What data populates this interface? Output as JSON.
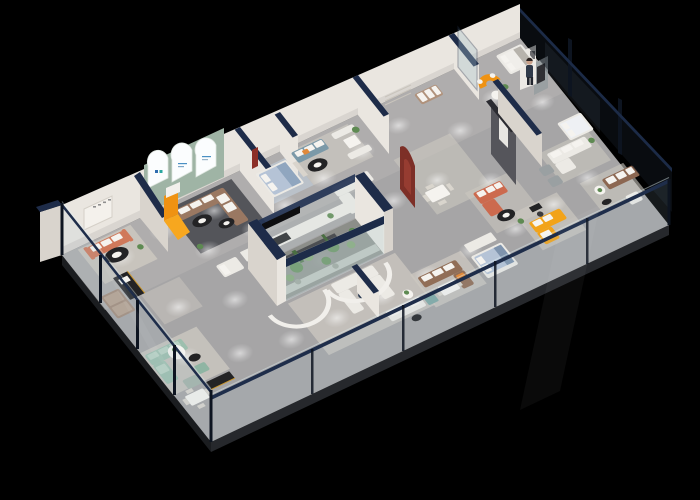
{
  "meta": {
    "type": "3d-isometric-floorplan-render",
    "subject": "Photorealistic isometric cutaway render of a furniture showroom interior on a black background",
    "background": "#000000",
    "width": 700,
    "height": 500
  },
  "palette": {
    "bg": "#000000",
    "floor": "#a6a5a6",
    "floorLight": "#b8b6b4",
    "slab": "#26282c",
    "slabDark": "#1b1d20",
    "wall": "#eae6e0",
    "wallShade": "#d9d4cd",
    "navy": "#1e2c49",
    "sage": "#9fb4a5",
    "glassLight": "#aFc8d2",
    "glassDark": "#141b22",
    "mullion": "#0d1420",
    "white": "#eceae5",
    "cushion": "#f5f3ef",
    "black": "#232325",
    "gray": "#9aa0a2",
    "rugLight": "#ccc8c0",
    "rugDark": "#54555a",
    "coral": "#d0795b",
    "brown": "#9a7862",
    "brown2": "#916e57",
    "taupe": "#a38b7a",
    "tan": "#b0927c",
    "blueGray": "#7b99a8",
    "bedBlue": "#b5c3d6",
    "mint": "#9dbfae",
    "mintDeep": "#8fb5a3",
    "teal": "#7fa8a5",
    "orange": "#ef9212",
    "orangeLight": "#f7a71f",
    "orangeAccent": "#e0893a",
    "yellow": "#f2a319",
    "redOrange": "#cc6a4e",
    "maroon": "#7d2f27",
    "leather": "#8c6751",
    "darkWall": "#55555b",
    "plant": "#5e8a52",
    "plantDark": "#4a6e42",
    "skin": "#caa18a",
    "suit": "#303a49"
  },
  "scene": {
    "view": "high-angle isometric, building runs diagonally from lower-left to upper-right",
    "perimeter": "glass curtain walls with navy top rails on front, left and right sides; solid white wall with room partitions along the back",
    "rooms": [
      {
        "name": "coral-sofa-lounge",
        "furniture": "coral sofa with white cushions, black oval coffee table, wall niche with sign"
      },
      {
        "name": "arched-window-room",
        "furniture": "three glowing arched windows on sage wall, orange kids slide, brown L-sofa on dark rug, two black coffee tables"
      },
      {
        "name": "blue-bedroom",
        "furniture": "light blue bed with white pillows"
      },
      {
        "name": "blue-sofa-room",
        "furniture": "blue-gray sofa with orange pillow, black oval table, white dining booth with plant"
      },
      {
        "name": "mid-lounge",
        "furniture": "white L-sofa, navy table, round dining table with chairs, tan sofa"
      },
      {
        "name": "entrance",
        "furniture": "curved orange sofa, greeter figure, glass door"
      },
      {
        "name": "right-wing",
        "furniture": "white bed, gray headboard wall, white sofa with chaise, gray armchairs, brown leather sofa with white armchair"
      },
      {
        "name": "terrarium",
        "furniture": "glass display box with cacti, plants, pebbles and navy fascia band, white end columns"
      },
      {
        "name": "mint-corner",
        "furniture": "mint green sectional, ottoman, round table, white dining set, black media consoles with brass trim"
      },
      {
        "name": "center-lounge",
        "furniture": "white booth sofas, white sofa with teal ottoman, curved white cove walls"
      },
      {
        "name": "brown-dining-room",
        "furniture": "brown L-sofa with orange cushion, white dining table"
      },
      {
        "name": "front-bedroom",
        "furniture": "light blue bed with wardrobe"
      },
      {
        "name": "red-sofa-room",
        "furniture": "red-orange sectional, dark feature wall with art panel, maroon display wall"
      },
      {
        "name": "yellow-sofa-room",
        "furniture": "bright yellow L-sofa, desk and chair, plant"
      }
    ],
    "lighting": "recessed ceiling spotlights casting round light pools on the gray floor"
  }
}
